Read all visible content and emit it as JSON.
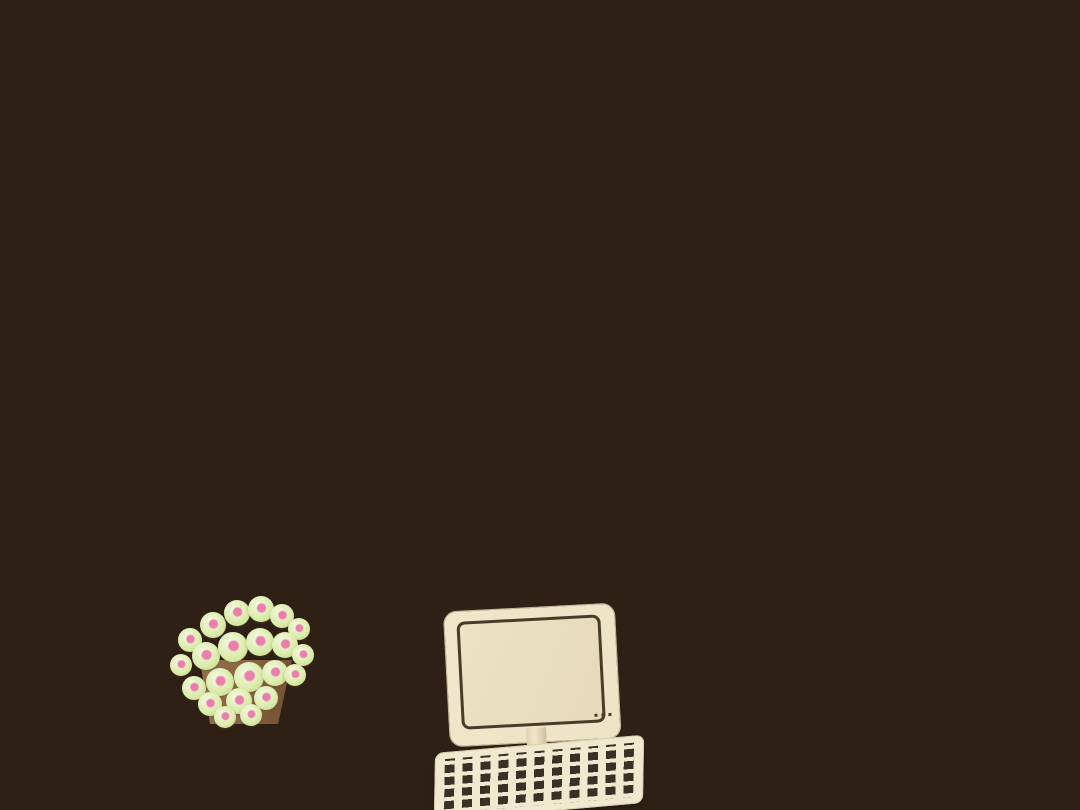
{
  "scene": {
    "type": "photograph",
    "subject": "Overhead view of a laser-cut plywood miniature interior-design scale model (dollhouse style apartment)",
    "visible_objects": [
      "plywood walls with dark burnt laser-cut edges",
      "white acrylic tv wall panels with wood divider strip",
      "black wall-mounted flat screen tv",
      "interior six-pane grid window with green plant behind",
      "white lace curtain on dark rod over left window",
      "jute rope shelf column between walls",
      "large wall opening with folding wooden lattice screens",
      "inner room with white floor, gray rug and round draped table",
      "white door panel",
      "small white wall switch",
      "round dark basin on far wall",
      "plywood desk and side table",
      "wooden computer monitor with engraved screen outline",
      "wooden keyboard with engraved keys",
      "brown pot with green flower buds tipped pink",
      "finger-joint tabs on right wall",
      "glass tabletop and white drape background"
    ],
    "text_visible": "none"
  },
  "palette": {
    "bg_glass": "#b9c4be",
    "bg_drape": "#e4e8e7",
    "table_white": "#eaecea",
    "wall_far": "#e8dcc0",
    "wall_tan": "#d3bd92",
    "wall_cream": "#ead9b8",
    "wall_deep": "#c9ae80",
    "edge_dark": "#33241a",
    "edge_mid": "#6b4a2e",
    "edge_light": "#caa877",
    "panel_white": "#f4f6f9",
    "strip_wood": "#cdb286",
    "tv_black": "#111111",
    "window_frame": "#d9d2bf",
    "pane_dark": "#343129",
    "lattice": "#9b7848",
    "floor_white": "#eef0f0",
    "rug_gray": "#8e98a0",
    "cloth_gray": "#c2c1bb",
    "desk_light": "#e7dab2",
    "desk_mid": "#dccca0",
    "device": "#ede3c6",
    "device_line": "#4a3b28",
    "key": "#3a3126",
    "pot": "#8a6443",
    "bud": "#dcecac",
    "bud_pink": "#ea7fae",
    "leaf": "#4f7c49",
    "curtain": "#f1f3f3",
    "rod": "#241a12",
    "door_white": "#f3f5f8"
  }
}
